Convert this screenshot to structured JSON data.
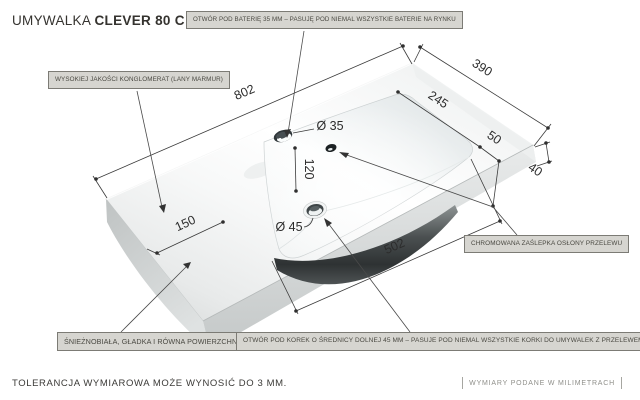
{
  "title": {
    "product_type": "UMYWALKA",
    "model": "CLEVER 80 C"
  },
  "callouts": {
    "faucet_hole": "OTWÓR POD BATERIĘ 35 MM – PASUJĘ POD NIEMAL WSZYSTKIE BATERIE NA RYNKU",
    "material": "WYSOKIEJ JAKOŚCI KONGLOMERAT (LANY MARMUR)",
    "overflow_cap": "CHROMOWANA ZAŚLEPKA OSŁONY PRZELEWU",
    "surface": "ŚNIEŻNOBIAŁA, GŁADKA I RÓWNA POWIERZCHNIA",
    "drain_hole": "OTWÓR POD KOREK O ŚREDNICY DOLNEJ 45 MM – PASUJE POD NIEMAL WSZYSTKIE KORKI DO UMYWALEK Z PRZELEWEM"
  },
  "dimensions": {
    "length": "802",
    "depth": "390",
    "bowl_depth": "245",
    "overflow_offset": "50",
    "thickness": "40",
    "faucet_to_bowl": "120",
    "left_margin": "150",
    "bowl_length": "502",
    "faucet_hole_diameter": "Ø 35",
    "drain_hole_diameter": "Ø 45"
  },
  "footer": {
    "tolerance_note": "TOLERANCJA WYMIAROWA MOŻE WYNOSIĆ DO 3 MM.",
    "units_note": "WYMIARY PODANE W MILIMETRACH"
  },
  "colors": {
    "callout_bg": "#d6d5d0",
    "callout_border": "#7c7b75",
    "dimension_line": "#3a3a3a",
    "surface_highlight": "#ffffff",
    "surface_shade": "#d4d7d7"
  }
}
